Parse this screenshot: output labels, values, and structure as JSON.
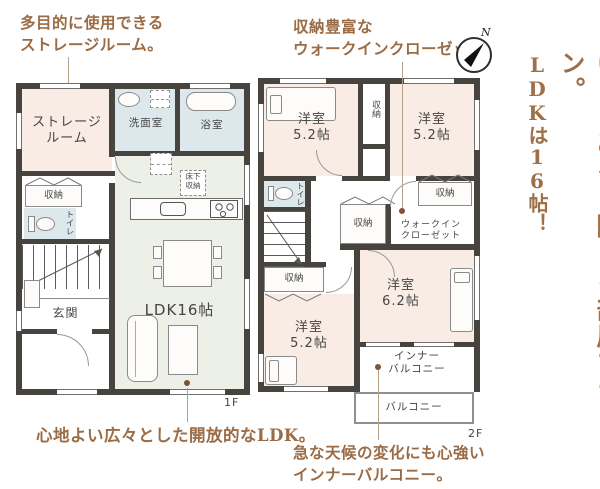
{
  "headline": {
    "line1": "ゆとりある2階・4部屋プラン。",
    "line2": "LDKは16帖！"
  },
  "annotations": {
    "storage": "多目的に使用できる\nストレージルーム。",
    "wic": "収納豊富な\nウォークインクローゼット。",
    "ldk": "心地よい広々とした開放的なLDK。",
    "balcony": "急な天候の変化にも心強い\nインナーバルコニー。"
  },
  "compass": {
    "north": "N"
  },
  "floor1": {
    "label": "1F",
    "storage_room": "ストレージ\nルーム",
    "washroom": "洗面室",
    "bathroom": "浴室",
    "closet": "収納",
    "toilet": "トイレ",
    "underfloor_storage": "床下\n収納",
    "entrance": "玄関",
    "ldk": "LDK16帖"
  },
  "floor2": {
    "label": "2F",
    "bedroom_nw": "洋室\n5.2帖",
    "bedroom_ne": "洋室\n5.2帖",
    "bedroom_sw": "洋室\n5.2帖",
    "bedroom_se": "洋室\n6.2帖",
    "closet_top": "収納",
    "closet_mid": "収納",
    "closet_right": "収納",
    "closet_sw": "収納",
    "toilet": "トイレ",
    "walk_in_closet": "ウォークイン\nクローゼット",
    "inner_balcony": "インナー\nバルコニー",
    "balcony": "バルコニー"
  },
  "colors": {
    "wall": "#47433f",
    "room_pink": "#f8ece5",
    "room_green": "#edf0e7",
    "room_blue": "#dce8ec",
    "accent_brown": "#9a6b44"
  }
}
